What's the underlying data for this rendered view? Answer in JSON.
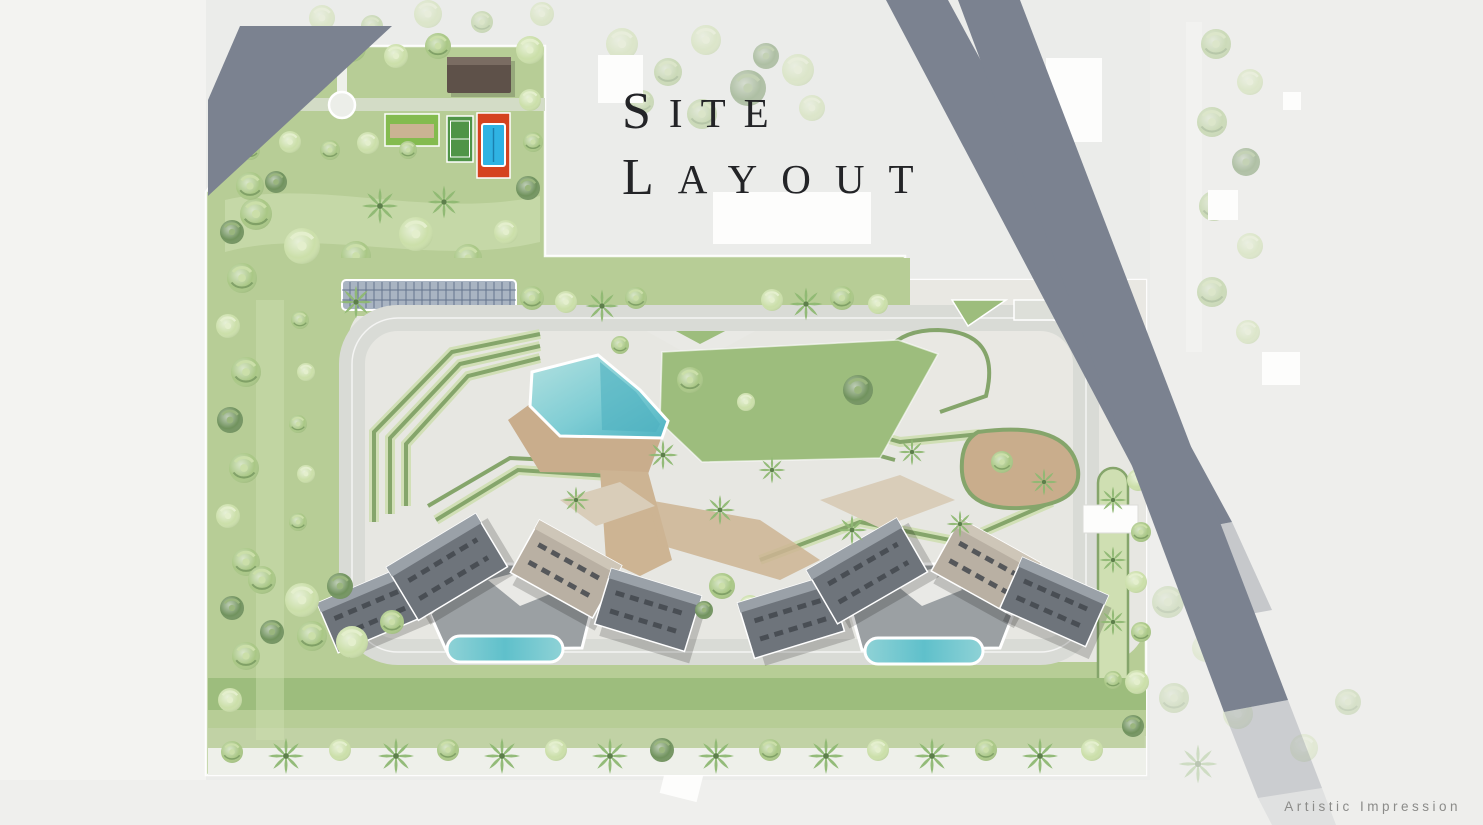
{
  "title": {
    "full": "SITE LAYOUT",
    "line1_initial": "S",
    "line1_rest": "ITE",
    "line2_initial": "L",
    "line2_rest": "AYOUT"
  },
  "caption": {
    "text": "Artistic Impression"
  },
  "features": [
    "clubhouse",
    "tennis-court",
    "pool-court",
    "lawn-panel",
    "circular-plaza",
    "pergola-canopy",
    "central-swimming-pool",
    "pool-deck",
    "central-lawn",
    "terraced-gardens",
    "residential-tower",
    "podium",
    "lap-pool",
    "perimeter-trees",
    "entrance-canopy",
    "hedge-strip",
    "main-roads"
  ],
  "palette": {
    "bg": "#ebecea",
    "margin": "#f3f3f1",
    "road": "#7b8290",
    "hard": "#e7e7e2",
    "plaza": "#e9e8e3",
    "lawn": "#b7cd96",
    "lawn_dark": "#9dbd7d",
    "lawn_light": "#cfdfb2",
    "loop_road": "#d9dbd6",
    "hedge": "#85a56b",
    "tree_mid": "#a9c785",
    "tree_light": "#cbdfa9",
    "tree_dark": "#70925d",
    "palm": "#8fb973",
    "pool_light": "#a9dcdd",
    "pool_dark": "#57b9c5",
    "deck": "#c9ad8c",
    "walkway": "#cdb493",
    "roof_dark": "#6e747b",
    "roof_mid": "#9aa1a8",
    "roof_tan": "#b9b0a3",
    "roof_vent": "#43484e",
    "podium": "#9ba0a3",
    "court_red": "#d5431f",
    "court_green": "#4f9447",
    "pool_blue": "#2fb3e3",
    "clubhouse": "#5e5149",
    "pergola": "#a9b4c2",
    "pergola_line": "#4f607c",
    "band_light": "#c3d2a8",
    "strip_white": "#eef0ea",
    "white": "#fdfdfc",
    "text": "#232427",
    "caption": "#8b8b89"
  }
}
